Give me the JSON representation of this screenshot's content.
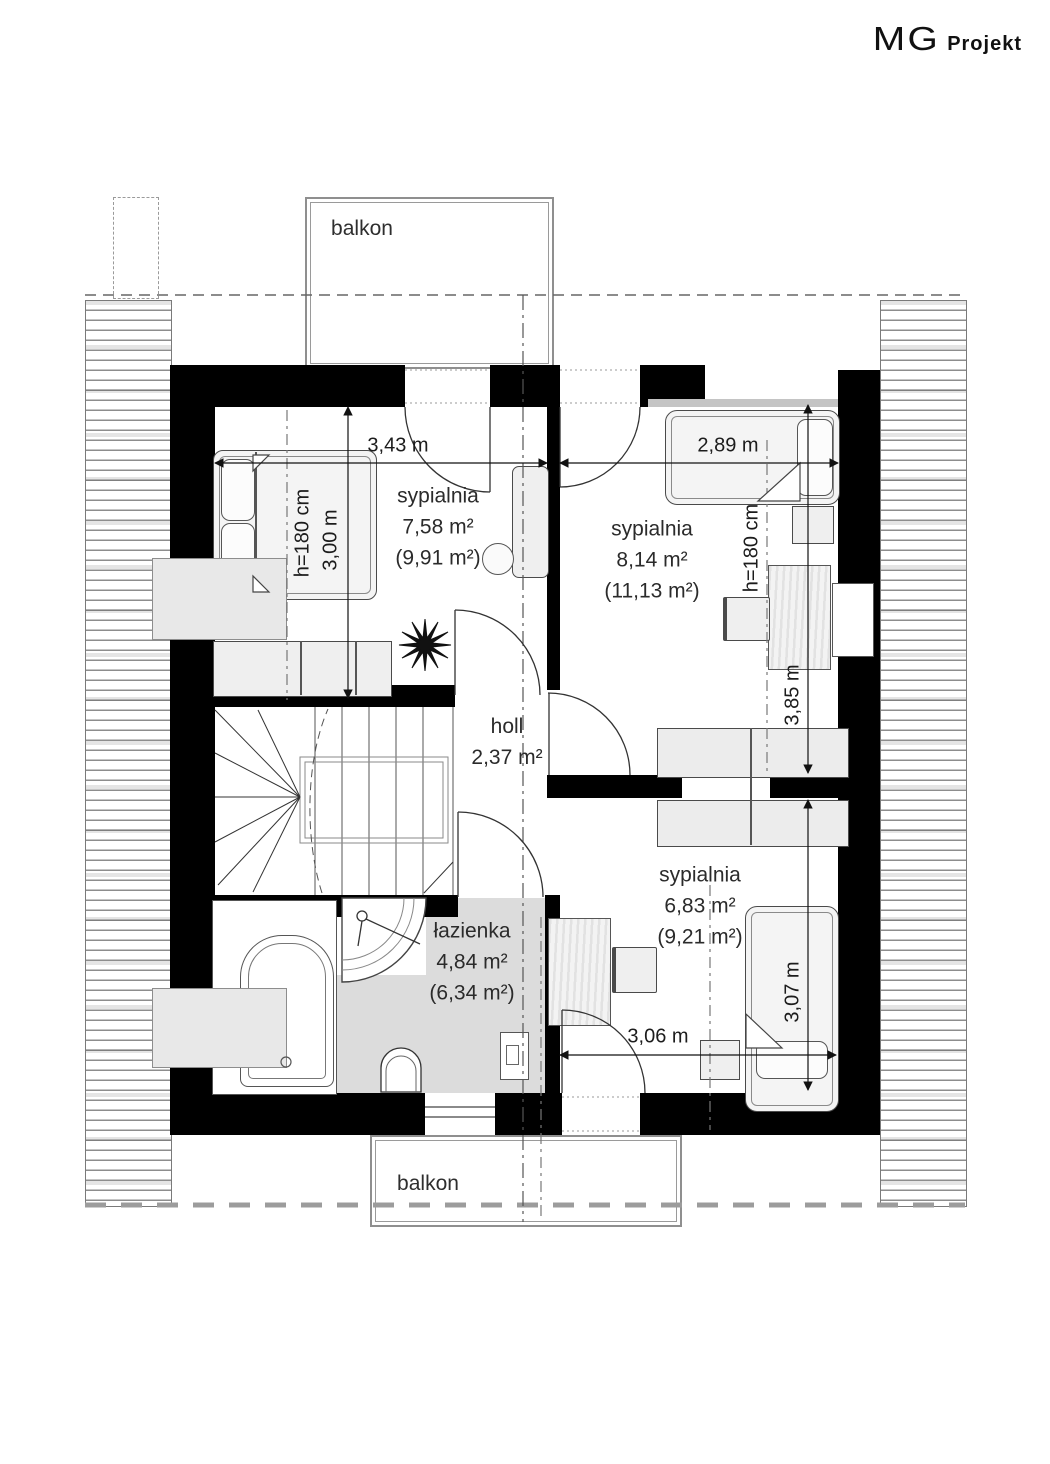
{
  "logo": {
    "mg": "MG",
    "projekt": "Projekt"
  },
  "balcony": {
    "top_label": "balkon",
    "bottom_label": "balkon"
  },
  "rooms": [
    {
      "id": "bedroom-1",
      "name": "sypialnia",
      "area": "7,58 m²",
      "gross": "(9,91 m²)"
    },
    {
      "id": "bedroom-2",
      "name": "sypialnia",
      "area": "8,14 m²",
      "gross": "(11,13 m²)"
    },
    {
      "id": "hall",
      "name": "holl",
      "area": "2,37 m²"
    },
    {
      "id": "bathroom",
      "name": "łazienka",
      "area": "4,84 m²",
      "gross": "(6,34 m²)"
    },
    {
      "id": "bedroom-3",
      "name": "sypialnia",
      "area": "6,83 m²",
      "gross": "(9,21 m²)"
    }
  ],
  "dims": {
    "b1_w": "3,43 m",
    "b1_h": "3,00 m",
    "b2_w": "2,89 m",
    "b2_h": "3,85 m",
    "b3_w": "3,06 m",
    "b3_h": "3,07 m",
    "attic_left": "h=180 cm",
    "attic_right": "h=180 cm"
  }
}
